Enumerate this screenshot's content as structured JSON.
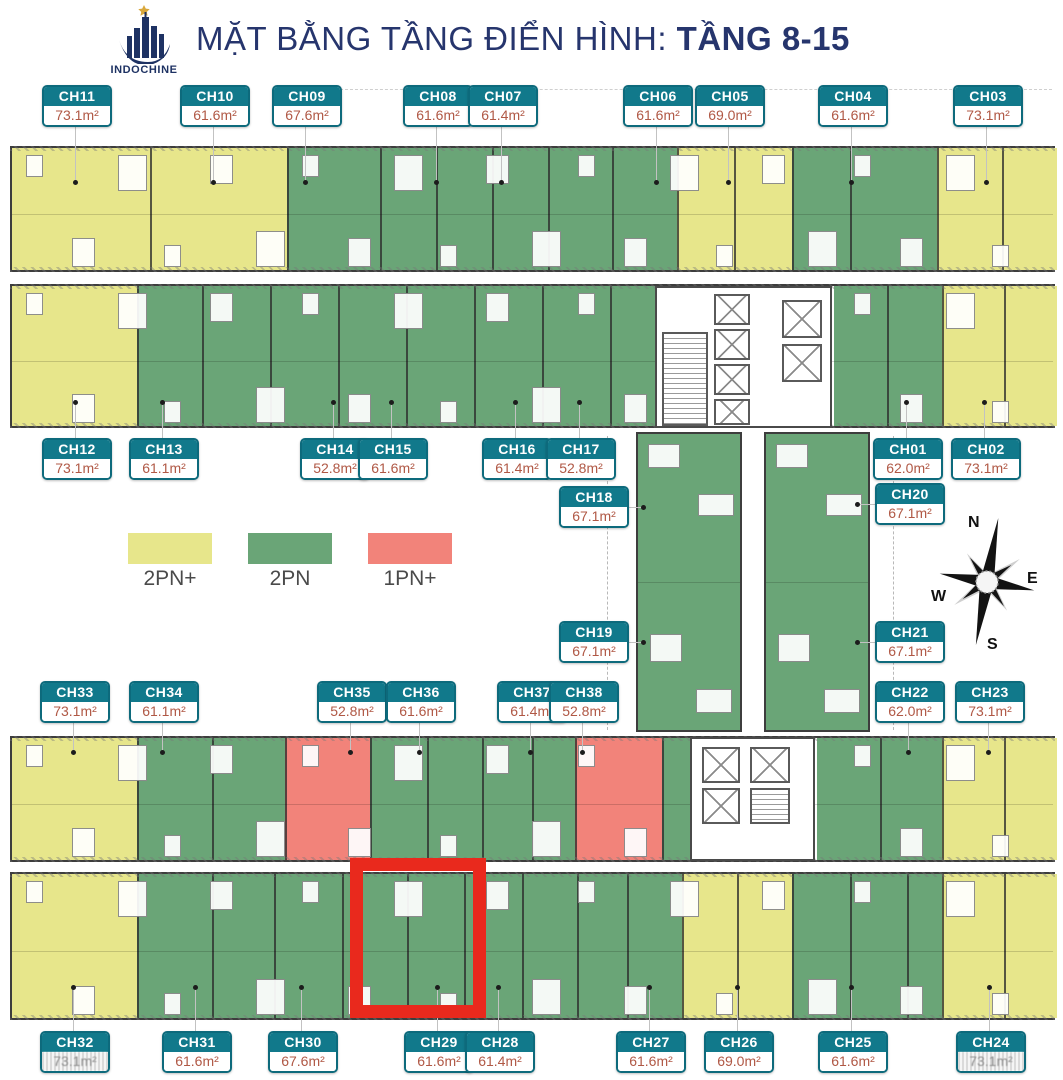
{
  "header": {
    "brand": "INDOCHINE",
    "title_prefix": "MẶT BẰNG TẦNG ĐIỂN HÌNH: ",
    "title_bold": "TẦNG 8-15"
  },
  "legend": [
    {
      "label": "2PN+",
      "color": "#e7e68b"
    },
    {
      "label": "2PN",
      "color": "#6aa577"
    },
    {
      "label": "1PN+",
      "color": "#f2837a"
    }
  ],
  "compass": {
    "north": "N",
    "east": "E",
    "south": "S",
    "west": "W"
  },
  "colors": {
    "label_teal": "#11798b",
    "area_text": "#b05845",
    "title_navy": "#26356d",
    "highlight_red": "#e9291d",
    "unit_yellow": "#e7e68b",
    "unit_green": "#6aa577",
    "unit_salmon": "#f2837a"
  },
  "highlight": {
    "unit": "CH29"
  },
  "units": [
    {
      "code": "CH11",
      "area": "73.1m²"
    },
    {
      "code": "CH10",
      "area": "61.6m²"
    },
    {
      "code": "CH09",
      "area": "67.6m²"
    },
    {
      "code": "CH08",
      "area": "61.6m²"
    },
    {
      "code": "CH07",
      "area": "61.4m²"
    },
    {
      "code": "CH06",
      "area": "61.6m²"
    },
    {
      "code": "CH05",
      "area": "69.0m²"
    },
    {
      "code": "CH04",
      "area": "61.6m²"
    },
    {
      "code": "CH03",
      "area": "73.1m²"
    },
    {
      "code": "CH12",
      "area": "73.1m²"
    },
    {
      "code": "CH13",
      "area": "61.1m²"
    },
    {
      "code": "CH14",
      "area": "52.8m²"
    },
    {
      "code": "CH15",
      "area": "61.6m²"
    },
    {
      "code": "CH16",
      "area": "61.4m²"
    },
    {
      "code": "CH17",
      "area": "52.8m²"
    },
    {
      "code": "CH01",
      "area": "62.0m²"
    },
    {
      "code": "CH02",
      "area": "73.1m²"
    },
    {
      "code": "CH18",
      "area": "67.1m²"
    },
    {
      "code": "CH20",
      "area": "67.1m²"
    },
    {
      "code": "CH19",
      "area": "67.1m²"
    },
    {
      "code": "CH21",
      "area": "67.1m²"
    },
    {
      "code": "CH33",
      "area": "73.1m²"
    },
    {
      "code": "CH34",
      "area": "61.1m²"
    },
    {
      "code": "CH35",
      "area": "52.8m²"
    },
    {
      "code": "CH36",
      "area": "61.6m²"
    },
    {
      "code": "CH37",
      "area": "61.4m²"
    },
    {
      "code": "CH38",
      "area": "52.8m²"
    },
    {
      "code": "CH22",
      "area": "62.0m²"
    },
    {
      "code": "CH23",
      "area": "73.1m²"
    },
    {
      "code": "CH32",
      "area": "73.1m²",
      "area_legible": false
    },
    {
      "code": "CH31",
      "area": "61.6m²"
    },
    {
      "code": "CH30",
      "area": "67.6m²"
    },
    {
      "code": "CH29",
      "area": "61.6m²"
    },
    {
      "code": "CH28",
      "area": "61.4m²"
    },
    {
      "code": "CH27",
      "area": "61.6m²"
    },
    {
      "code": "CH26",
      "area": "69.0m²"
    },
    {
      "code": "CH25",
      "area": "61.6m²"
    },
    {
      "code": "CH24",
      "area": "73.1m²",
      "area_legible": false
    }
  ]
}
